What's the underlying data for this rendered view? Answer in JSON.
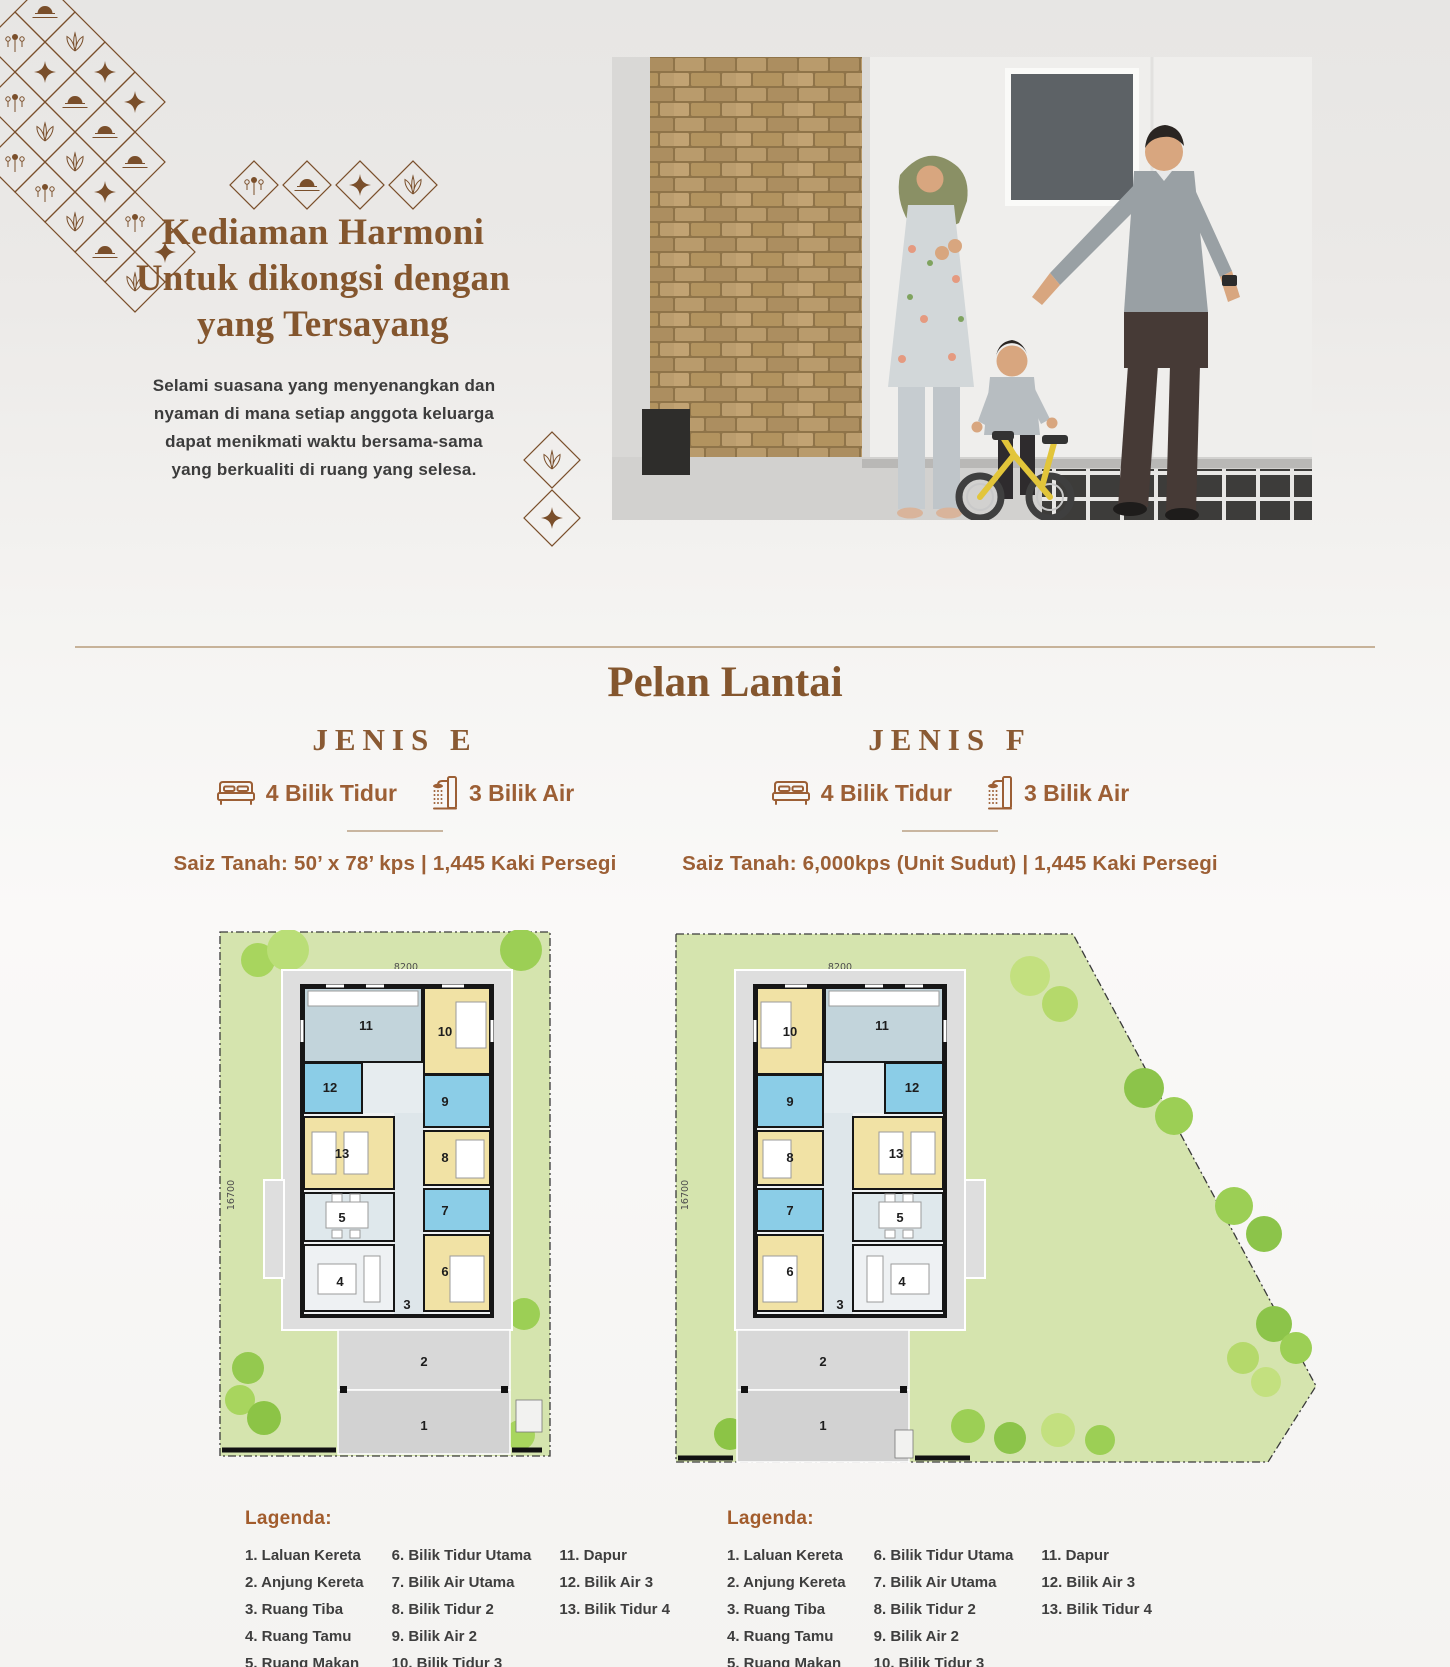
{
  "hero": {
    "title_lines": [
      "Kediaman Harmoni",
      "Untuk dikongsi dengan",
      "yang Tersayang"
    ],
    "description": "Selami suasana yang menyenangkan dan nyaman di mana setiap anggota keluarga dapat menikmati waktu bersama-sama yang berkualiti di ruang yang selesa."
  },
  "section": {
    "title": "Pelan Lantai"
  },
  "plans": [
    {
      "name": "JENIS E",
      "bedrooms": "4 Bilik Tidur",
      "bathrooms": "3 Bilik Air",
      "size": "Saiz Tanah: 50’ x 78’ kps | 1,445 Kaki Persegi",
      "dimensions": {
        "width": "8200",
        "depth": "16700"
      },
      "room_labels": [
        "1",
        "2",
        "3",
        "4",
        "5",
        "6",
        "7",
        "8",
        "9",
        "10",
        "11",
        "12",
        "13"
      ]
    },
    {
      "name": "JENIS F",
      "bedrooms": "4 Bilik Tidur",
      "bathrooms": "3 Bilik Air",
      "size": "Saiz Tanah: 6,000kps (Unit Sudut) | 1,445 Kaki Persegi",
      "dimensions": {
        "width": "8200",
        "depth": "16700"
      },
      "room_labels": [
        "1",
        "2",
        "3",
        "4",
        "5",
        "6",
        "7",
        "8",
        "9",
        "10",
        "11",
        "12",
        "13"
      ]
    }
  ],
  "legend": {
    "heading": "Lagenda:",
    "columns": [
      [
        "1. Laluan Kereta",
        "2. Anjung Kereta",
        "3. Ruang Tiba",
        "4. Ruang Tamu",
        "5. Ruang Makan"
      ],
      [
        "6. Bilik Tidur Utama",
        "7. Bilik Air Utama",
        "8. Bilik Tidur 2",
        "9. Bilik Air 2",
        "10. Bilik Tidur 3"
      ],
      [
        "11. Dapur",
        "12. Bilik Air 3",
        "13. Bilik Tidur 4"
      ]
    ]
  },
  "colors": {
    "accent_brown": "#8a5a33",
    "feature_brown": "#9c5f35",
    "legend_brown": "#a25c2c",
    "text_dark": "#3c3c3c",
    "divider_tan": "#c7b299",
    "lawn_green": "#d5e4ae",
    "bedroom_yellow": "#f1e2a5",
    "bathroom_blue": "#8bcde7",
    "kitchen_bluegray": "#c2d4db",
    "pad_gray": "#dedede",
    "ornament_brown": "#7a4f2b"
  }
}
